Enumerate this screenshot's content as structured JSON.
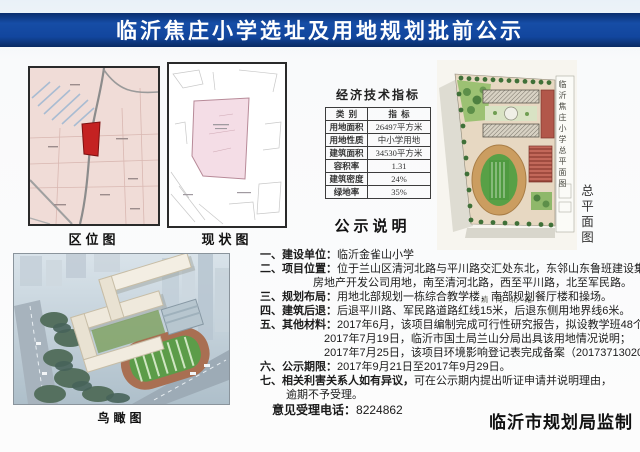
{
  "banner": {
    "title": "临沂焦庄小学选址及用地规划批前公示",
    "bg_color": "#12469e"
  },
  "maps": {
    "location_caption": "区位图",
    "status_caption": "现状图",
    "site_plan_caption": "总平面图",
    "site_plan_vertical_label": "临沂焦庄小学总平面图",
    "site_plan_road_label": "清河北路",
    "birdseye_caption": "鸟瞰图",
    "site_highlight_color": "#c42222"
  },
  "indicators": {
    "title": "经济技术指标",
    "header": {
      "category": "类  别",
      "value": "指  标"
    },
    "rows": [
      {
        "label": "用地面积",
        "value": "26497平方米"
      },
      {
        "label": "用地性质",
        "value": "中小学用地"
      },
      {
        "label": "建筑面积",
        "value": "34530平方米"
      },
      {
        "label": "容积率",
        "value": "1.31"
      },
      {
        "label": "建筑密度",
        "value": "24%"
      },
      {
        "label": "绿地率",
        "value": "35%"
      }
    ]
  },
  "notice": {
    "title": "公示说明",
    "lines": [
      {
        "num": "一、",
        "label": "建设单位：",
        "text": "临沂金雀山小学"
      },
      {
        "num": "二、",
        "label": "项目位置：",
        "text": "位于兰山区清河北路与平川路交汇处东北，东邻山东鲁班建设集团"
      },
      {
        "num": "",
        "label": "",
        "text": "房地产开发公司用地，南至清河北路，西至平川路，北至军民路。"
      },
      {
        "num": "三、",
        "label": "规划布局：",
        "text": "用地北部规划一栋综合教学楼，南部规划餐厅楼和操场。"
      },
      {
        "num": "四、",
        "label": "建筑后退：",
        "text": "后退平川路、军民路道路红线15米，后退东侧用地界线6米。"
      },
      {
        "num": "五、",
        "label": "其他材料：",
        "text": "2017年6月，该项目编制完成可行性研究报告，拟设教学班48个，"
      },
      {
        "num": "",
        "label": "",
        "text": "2017年7月19日，临沂市国土局兰山分局出具该用地情况说明；"
      },
      {
        "num": "",
        "label": "",
        "text": "2017年7月25日，该项目环境影响登记表完成备案（201737130200000070）。"
      },
      {
        "num": "六、",
        "label": "公示期限：",
        "text": "2017年9月21日至2017年9月29日。"
      },
      {
        "num": "七、",
        "label": "相关利害关系人如有异议，",
        "text": "可在公示期内提出听证申请并说明理由，"
      },
      {
        "num": "",
        "label": "",
        "text": "逾期不予受理。"
      }
    ]
  },
  "footer": {
    "phone_label": "意见受理电话：",
    "phone_number": "8224862",
    "producer": "临沂市规划局监制"
  }
}
